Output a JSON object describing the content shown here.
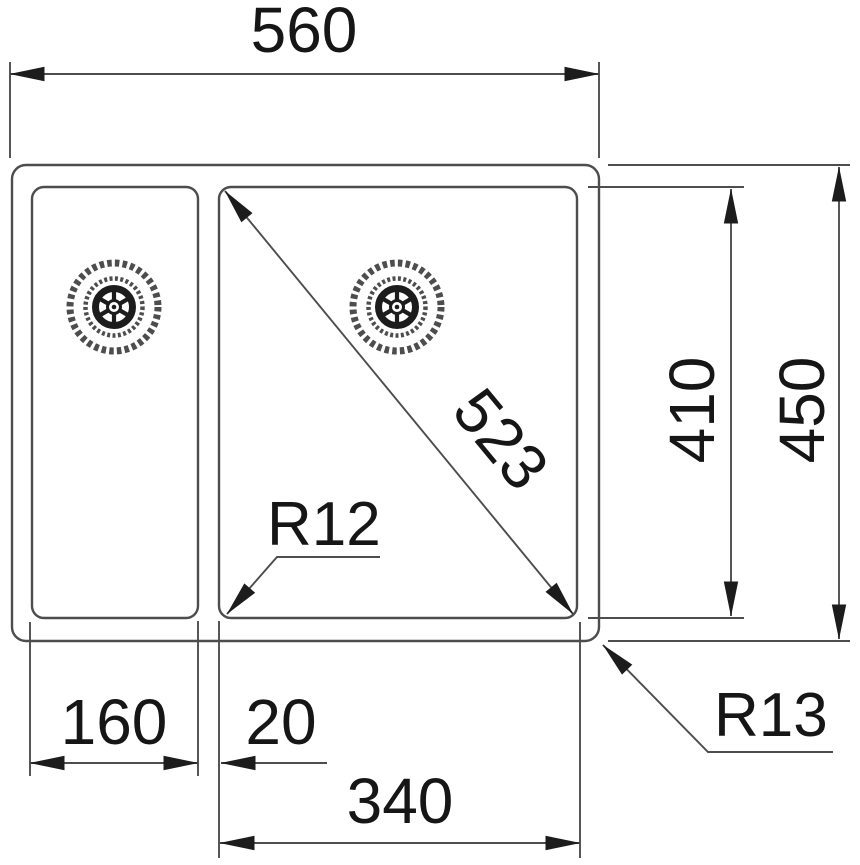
{
  "drawing": {
    "type": "technical-dimension-drawing",
    "subject": "double-bowl sink top view",
    "labels": {
      "overall_width": "560",
      "overall_depth": "450",
      "bowl_depth": "410",
      "bowl_diagonal": "523",
      "left_bowl_width": "160",
      "bowl_gap": "20",
      "right_bowl_width": "340",
      "bowl_corner_radius": "R12",
      "rim_corner_radius": "R13"
    },
    "colors": {
      "line": "#4d4d4d",
      "text": "#161616",
      "arrow": "#1c1c1c",
      "background": "#ffffff"
    },
    "icons": [
      {
        "name": "drain-strainer-icon",
        "glyph": "six-spoke wheel inside hatched rings"
      }
    ]
  }
}
